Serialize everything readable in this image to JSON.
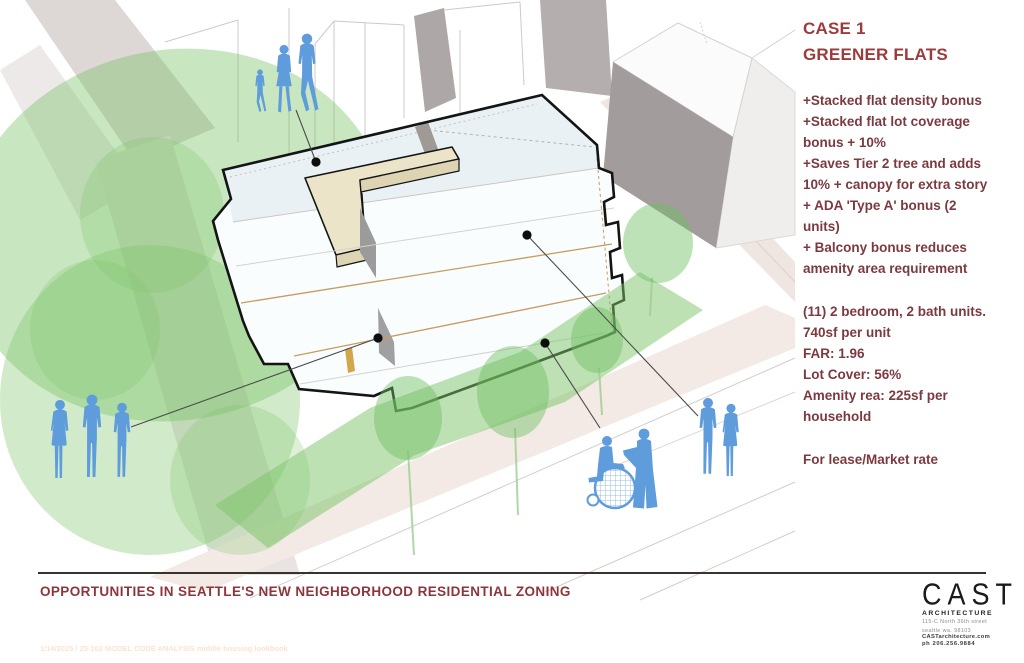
{
  "panel": {
    "case_label": "CASE 1",
    "title": "GREENER FLATS",
    "bullets": [
      "+Stacked flat density bonus",
      "+Stacked flat lot coverage\nbonus + 10%",
      "+Saves Tier 2 tree and adds\n10% + canopy for extra story",
      "+ ADA 'Type A' bonus (2\nunits)",
      "+ Balcony bonus reduces\namenity area requirement"
    ],
    "stats": [
      "(11) 2 bedroom, 2 bath units.",
      "740sf per unit",
      "FAR: 1.96",
      "Lot Cover: 56%",
      "Amenity rea: 225sf per\nhousehold"
    ],
    "availability": "For lease/Market rate"
  },
  "footer": {
    "title": "OPPORTUNITIES IN SEATTLE'S NEW NEIGHBORHOOD RESIDENTIAL ZONING",
    "watermark": "1/14/2025 / 25-102 MODEL CODE ANALYSIS middle housing lookbook"
  },
  "logo": {
    "name": "CAST",
    "subtitle": "ARCHITECTURE",
    "address_line1": "115-C North 36th street",
    "address_line2": "seattle  wa.  98103",
    "website": "CASTarchitecture.com",
    "phone": "ph 206.256.9884"
  },
  "colors": {
    "heading_red": "#9d3b3b",
    "body_red": "#7c3a40",
    "people_blue": "#5f9cdb",
    "tree_green": "#7cc468",
    "canopy_tan": "#ece4c9"
  }
}
